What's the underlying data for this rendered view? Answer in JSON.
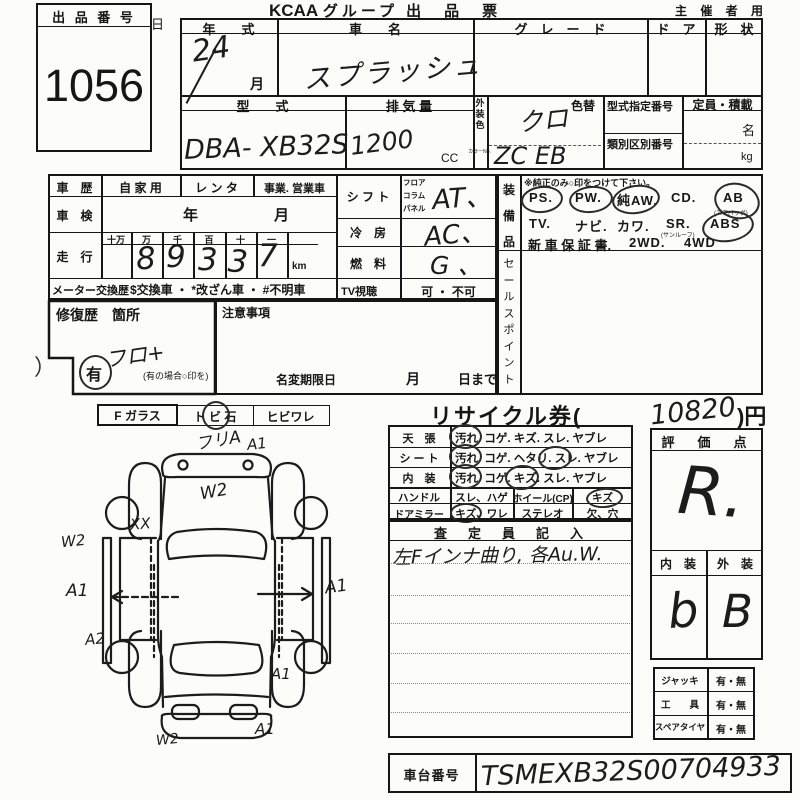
{
  "page": {
    "title_logo": "KCAA",
    "title_rest": "グループ 出　品　票",
    "holder": "主 催 者 用",
    "stray_day": "日"
  },
  "lot": {
    "label": "出 品 番 号",
    "number": "1056"
  },
  "vehicle": {
    "year_label": "年　　式",
    "year_value": "24",
    "month": "月",
    "name_label": "車　　名",
    "name_value": "スプラッシュ",
    "grade_label": "グ　レ　ー　ド",
    "door_label": "ド　ア",
    "shape_label": "形　状",
    "model_label": "型　　式",
    "model_value": "DBA- XB32S",
    "disp_label": "排 気 量",
    "disp_value": "1200",
    "disp_unit": "CC",
    "color_strip": [
      "外",
      "装",
      "色"
    ],
    "color_no": "カラーNo.",
    "color_change": "色替",
    "color_value": "クロ",
    "color_code": "ZC EB",
    "type_no_label": "型式指定番号",
    "class_no_label": "類別区別番号",
    "capacity_label": "定員・積載",
    "capacity_persons": "名",
    "capacity_kg": "kg"
  },
  "history": {
    "row_label": "車　歴",
    "private": "自 家 用",
    "rental": "レ ン タ",
    "business": "事業. 営業車",
    "shaken_label": "車　検",
    "shaken_year": "年",
    "shaken_month": "月",
    "mileage_label": "走　行",
    "mile_cols": [
      "十万",
      "万",
      "千",
      "百",
      "十",
      "一"
    ],
    "mile_digits": [
      "8",
      "9",
      "3",
      "3",
      "7"
    ],
    "mile_unit": "km",
    "meter_label": "メーター交換歴",
    "meter_text": "$交換車 ・ *改ざん車 ・ #不明車"
  },
  "drive": {
    "shift_label": "シ フ ト",
    "shift_opts": [
      "フロア",
      "コラム",
      "パネル"
    ],
    "shift_value": "AT、",
    "cool_label": "冷　房",
    "cool_value": "AC、",
    "fuel_label": "燃　料",
    "fuel_value": "G 、",
    "tv_label": "TV視聴",
    "tv_value": "可 ・ 不可"
  },
  "equipment": {
    "strip": [
      "装",
      "備",
      "品"
    ],
    "note": "※純正のみ○印をつけて下さい。",
    "r1": [
      "PS.",
      "PW.",
      "純AW.",
      "CD.",
      "AB"
    ],
    "r1_sub": "(エアバッグ)",
    "r2": [
      "TV.",
      "ナビ.",
      "カワ.",
      "SR.",
      "ABS"
    ],
    "r2_sub": "(サンルーフ)",
    "r3": [
      "新 車 保 証 書.",
      "2WD.",
      "4WD"
    ],
    "sales_strip": [
      "セ",
      "ー",
      "ル",
      "ス",
      "ポ",
      "イ",
      "ン",
      "ト"
    ]
  },
  "repair": {
    "label": "修復歴　箇所",
    "yes": "有",
    "hand": "フロ+",
    "note": "(有の場合○印を)",
    "caution": "注意事項",
    "rename": "名変期限日",
    "rename_m": "月",
    "rename_d": "日まで",
    "stray": "）"
  },
  "recycle": {
    "pre": "リサイクル券(",
    "amount": "10820",
    "post": ")円"
  },
  "glass": {
    "label": "F ガラス",
    "opt1": "ト ビ 石",
    "opt2": "ヒビワレ"
  },
  "condition": {
    "rows": [
      {
        "label": "天　張",
        "opts": "汚れ. コゲ. キズ. スレ. ヤブレ"
      },
      {
        "label": "シ ー ト",
        "opts": "汚れ. コゲ. ヘタリ. スレ. ヤブレ"
      },
      {
        "label": "内　装",
        "opts": "汚れ. コゲ. キズ. スレ. ヤブレ"
      }
    ],
    "handle_label": "ハンドル",
    "handle_opts": "スレ、ハゲ",
    "wheel_label": "ホイール(CP)",
    "wheel_opts": "キズ",
    "mirror_label": "ドアミラー",
    "mirror_opts": "キズ、ワレ",
    "stereo_label": "ステレオ",
    "stereo_opts": "欠、穴"
  },
  "inspector": {
    "header": "査　定　員　記　入",
    "note": "左Fインナ曲り, 各Au.W."
  },
  "score": {
    "header": "評　価　点",
    "value": "R.",
    "int_label": "内　装",
    "ext_label": "外　装",
    "int_value": "b",
    "ext_value": "B"
  },
  "tools": {
    "rows": [
      {
        "label": "ジャッキ",
        "v": "有・無"
      },
      {
        "label": "工　　具",
        "v": "有・無"
      },
      {
        "label": "スペアタイヤ",
        "v": "有・無"
      }
    ]
  },
  "chassis": {
    "label": "車台番号",
    "value": "TSMEXB32S00704933"
  },
  "diagram": {
    "front_note": "フリA",
    "front_a1": "A1",
    "hood_w2": "W2",
    "left_w2": "W2",
    "left_xx": "XX",
    "left_a1": "A1",
    "right_a1": "A1",
    "left_a2": "A2",
    "rear_right_a1": "A1",
    "rear_w2": "W2",
    "rear_a1": "A1"
  }
}
